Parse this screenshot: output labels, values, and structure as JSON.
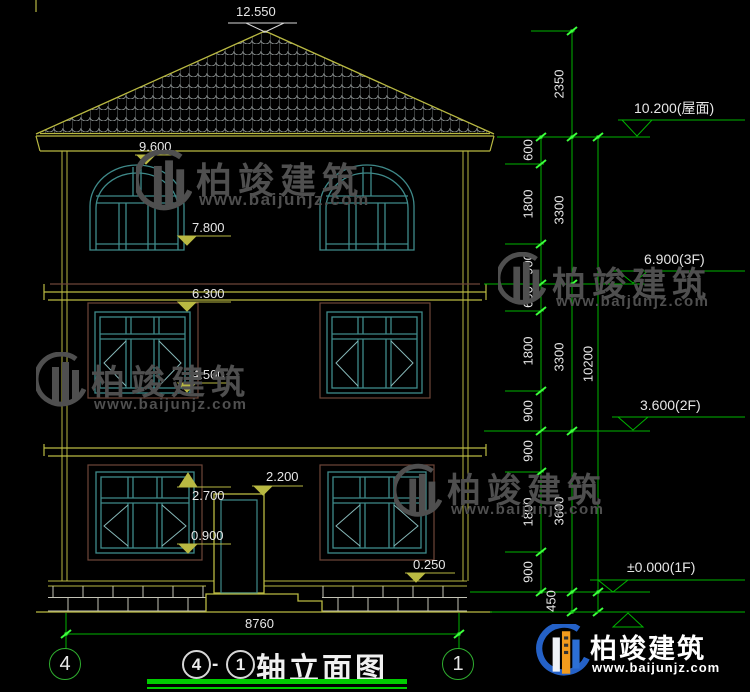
{
  "drawing": {
    "title": "轴立面图",
    "axis_start": "4",
    "axis_end": "1",
    "separator": "-",
    "width_total": "8760",
    "height_total": "10200",
    "ground_offset": "450"
  },
  "facade_levels": {
    "roof_peak": "12.550",
    "win3_top": "9.600",
    "win3_bottom": "7.800",
    "win2_top": "6.300",
    "win2_bottom": "4.500",
    "win1_top": "2.700",
    "win1_bottom": "0.900",
    "door_top": "2.200",
    "plinth_top": "0.250"
  },
  "right_levels": {
    "roof": "10.200(屋面)",
    "f3": "6.900(3F)",
    "f2": "3.600(2F)",
    "f1": "±0.000(1F)"
  },
  "segments": [
    "600",
    "1800",
    "900",
    "600",
    "1800",
    "900",
    "900",
    "1800",
    "900"
  ],
  "floors": [
    "2350",
    "3300",
    "3300",
    "3600"
  ],
  "watermark": {
    "brand": "柏竣建筑",
    "url": "www.baijunjz.com"
  }
}
